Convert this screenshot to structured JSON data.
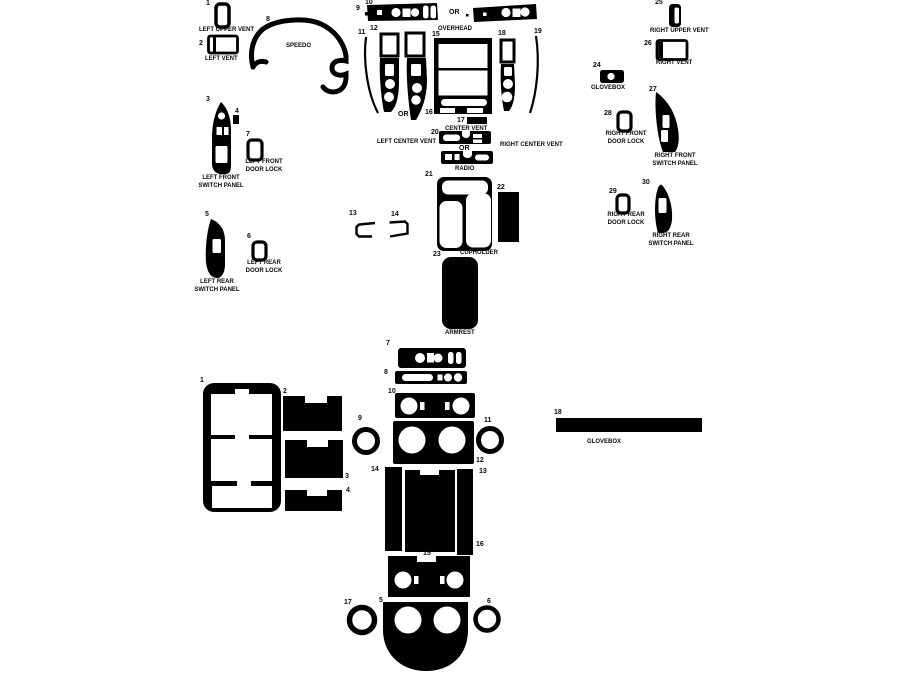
{
  "page": {
    "background": "#ffffff",
    "piece_color": "#000000",
    "cutout_color": "#ffffff"
  },
  "upper_kit": {
    "or_overhead": "OR",
    "or_left_center_vent": "OR",
    "or_radio": "OR",
    "parts": {
      "left_upper_vent": {
        "num": "1",
        "label": "LEFT UPPER VENT"
      },
      "left_vent": {
        "num": "2",
        "label": "LEFT VENT"
      },
      "left_front_switch_panel": {
        "num": "3",
        "label": "LEFT FRONT SWITCH PANEL"
      },
      "switch_insert": {
        "num": "4"
      },
      "left_rear_switch_panel": {
        "num": "5",
        "label": "LEFT REAR SWITCH PANEL"
      },
      "left_rear_door_lock": {
        "num": "6",
        "label": "LEFT REAR DOOR LOCK"
      },
      "left_front_door_lock": {
        "num": "7",
        "label": "LEFT FRONT DOOR LOCK"
      },
      "speedo": {
        "num": "8",
        "label": "SPEEDO"
      },
      "overhead_small": {
        "num": "9"
      },
      "overhead": {
        "num": "10",
        "label": "OVERHEAD"
      },
      "left_center_vent_sliver": {
        "num": "11"
      },
      "left_center_vent": {
        "num": "12",
        "label": "LEFT CENTER VENT"
      },
      "bracket_left": {
        "num": "13"
      },
      "bracket_right": {
        "num": "14"
      },
      "center_stack": {
        "num": "15"
      },
      "center_stack_lower": {
        "num": "16"
      },
      "center_vent": {
        "num": "17",
        "label": "CENTER VENT"
      },
      "right_center_vent_pillar": {
        "num": "18"
      },
      "right_center_vent_sliver": {
        "num": "19",
        "label": "RIGHT CENTER VENT"
      },
      "radio": {
        "num": "20",
        "label": "RADIO"
      },
      "cupholder": {
        "num": "21",
        "label": "CUPHOLDER"
      },
      "console_side": {
        "num": "22"
      },
      "armrest": {
        "num": "23",
        "label": "ARMREST"
      },
      "glovebox": {
        "num": "24",
        "label": "GLOVEBOX"
      },
      "right_upper_vent": {
        "num": "25",
        "label": "RIGHT UPPER VENT"
      },
      "right_vent": {
        "num": "26",
        "label": "RIGHT VENT"
      },
      "right_front_switch_panel": {
        "num": "27",
        "label": "RIGHT FRONT SWITCH PANEL"
      },
      "right_front_door_lock": {
        "num": "28",
        "label": "RIGHT FRONT DOOR LOCK"
      },
      "right_rear_door_lock": {
        "num": "29",
        "label": "RIGHT REAR DOOR LOCK"
      },
      "right_rear_switch_panel": {
        "num": "30",
        "label": "RIGHT REAR SWITCH PANEL"
      }
    }
  },
  "lower_kit": {
    "parts": {
      "door_frame": {
        "num": "1"
      },
      "door_insert_top": {
        "num": "2"
      },
      "door_insert_mid": {
        "num": "3"
      },
      "door_insert_small": {
        "num": "4"
      },
      "lower_console": {
        "num": "5"
      },
      "ring_lower_right": {
        "num": "6"
      },
      "switch_bar": {
        "num": "7"
      },
      "trim_strip": {
        "num": "8"
      },
      "ring_upper_left": {
        "num": "9"
      },
      "vent_panel": {
        "num": "10"
      },
      "ring_upper_right": {
        "num": "11"
      },
      "gauge_panel": {
        "num": "12"
      },
      "pillar_right": {
        "num": "13"
      },
      "pillar_left": {
        "num": "14"
      },
      "lower_vent_panel": {
        "num": "15"
      },
      "center_console_panel": {
        "num": "16"
      },
      "ring_lower_left": {
        "num": "17"
      },
      "glovebox": {
        "num": "18",
        "label": "GLOVEBOX"
      }
    }
  }
}
